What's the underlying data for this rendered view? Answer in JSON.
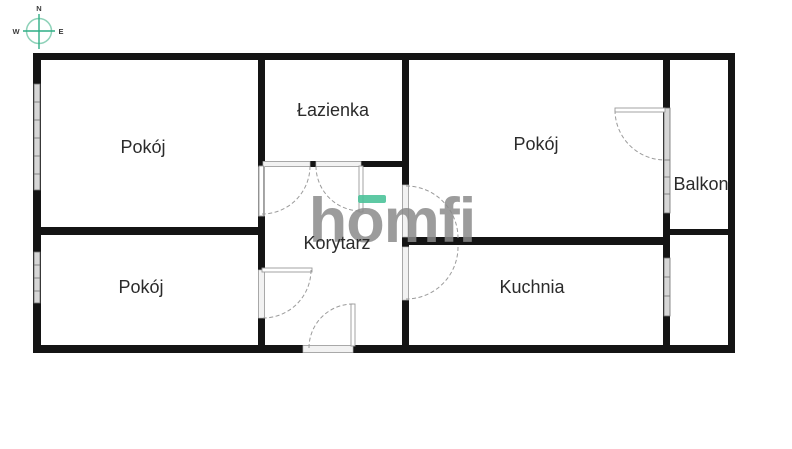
{
  "plan": {
    "type": "apartment-floor-plan",
    "rooms": [
      {
        "id": "room-top-left",
        "label": "Pokój"
      },
      {
        "id": "bathroom",
        "label": "Łazienka"
      },
      {
        "id": "room-top-right",
        "label": "Pokój"
      },
      {
        "id": "balcony",
        "label": "Balkon"
      },
      {
        "id": "room-bottom-left",
        "label": "Pokój"
      },
      {
        "id": "hallway",
        "label": "Korytarz"
      },
      {
        "id": "kitchen",
        "label": "Kuchnia"
      }
    ],
    "compass": {
      "north": "N",
      "west": "W",
      "east": "E"
    },
    "watermark": {
      "text": "homfi"
    },
    "colors": {
      "wall": "#141414",
      "accent_green": "#4cc39a",
      "compass_teal": "#2fae85",
      "compass_ring": "#8fd2b9",
      "label": "#2b2b2b",
      "window_fill": "#d6d6d6",
      "arc": "#9b9b9b",
      "logo_gray": "#8a8a8a"
    }
  }
}
